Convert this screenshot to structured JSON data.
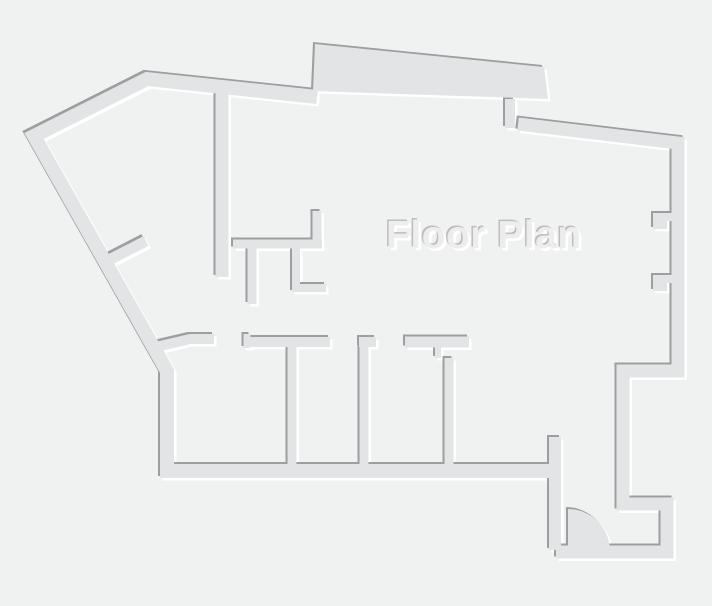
{
  "title": "Floor Plan",
  "canvas": {
    "width": 712,
    "height": 606
  },
  "colors": {
    "background": "#f0f1f1",
    "wall_fill": "#e3e4e5",
    "wall_shadow": "#9e9ea0",
    "wall_highlight": "#ffffff",
    "text_fill": "#ededee",
    "text_shadow": "#bdbdbe"
  },
  "emboss_layers": [
    {
      "id": "highlight",
      "dx": 2.5,
      "dy": 2.5,
      "colorKey": "wall_highlight"
    },
    {
      "id": "shadow",
      "dx": -2,
      "dy": -2,
      "colorKey": "wall_shadow"
    },
    {
      "id": "fill",
      "dx": 0,
      "dy": 0,
      "colorKey": "wall_fill"
    }
  ],
  "walls": [
    {
      "name": "outer-wall-left-and-bottom",
      "kind": "stroke",
      "w": 14,
      "d": "M 556 471 L 167 471 L 167 371 L 34 136 L 147 79 L 317 97"
    },
    {
      "name": "top-bump-slab",
      "kind": "fill",
      "w": 0,
      "d": "M 313 91 L 315 44 L 544 67 L 548 99 Z"
    },
    {
      "name": "outer-wall-right-and-vestibule",
      "kind": "stroke",
      "w": 13,
      "d": "M 518 124 L 678 143 L 678 371 L 623 371 L 623 504 L 667 504 L 667 552 L 556 552"
    },
    {
      "name": "entry-door-jamb",
      "kind": "stroke",
      "w": 12,
      "d": "M 555 437 L 555 550"
    },
    {
      "name": "right-wall-notch-upper",
      "kind": "stroke",
      "w": 8,
      "d": "M 677 217 L 657 217 L 657 225 L 667 225"
    },
    {
      "name": "right-wall-notch-lower",
      "kind": "stroke",
      "w": 8,
      "d": "M 677 279 L 657 279 L 657 287 L 667 287"
    },
    {
      "name": "interior-wall-vertical-left",
      "kind": "stroke",
      "w": 13,
      "d": "M 222 90 L 222 277"
    },
    {
      "name": "small-room-wall-horizontal",
      "kind": "stroke",
      "w": 9,
      "d": "M 233 244 L 322 244"
    },
    {
      "name": "small-room-stub-up",
      "kind": "stroke",
      "w": 9,
      "d": "M 317 248 L 317 211"
    },
    {
      "name": "small-room-partition",
      "kind": "stroke",
      "w": 9,
      "d": "M 252 247 L 252 304"
    },
    {
      "name": "small-room-l-wall",
      "kind": "stroke",
      "w": 8,
      "d": "M 296 248 L 296 288 L 326 288"
    },
    {
      "name": "diagonal-door-stub",
      "kind": "stroke",
      "w": 11,
      "d": "M 109 260 L 146 241"
    },
    {
      "name": "bump-under-stub",
      "kind": "stroke",
      "w": 10,
      "d": "M 510 99 L 510 128"
    },
    {
      "name": "room-header-slant-stub",
      "kind": "stroke",
      "w": 10,
      "d": "M 156 347 L 190 339 L 214 339"
    },
    {
      "name": "room-header-b-tab",
      "kind": "stroke",
      "w": 7,
      "d": "M 247 348 L 247 334"
    },
    {
      "name": "room-header-b",
      "kind": "stroke",
      "w": 10,
      "d": "M 244 342 L 330 342"
    },
    {
      "name": "room-header-c",
      "kind": "stroke",
      "w": 10,
      "d": "M 359 342 L 376 342"
    },
    {
      "name": "room-header-d",
      "kind": "stroke",
      "w": 11,
      "d": "M 405 342 L 469 342"
    },
    {
      "name": "room-header-d-tick",
      "kind": "stroke",
      "w": 6,
      "d": "M 438 344 L 438 358"
    },
    {
      "name": "room-partition-1",
      "kind": "stroke",
      "w": 9,
      "d": "M 292 341 L 292 466"
    },
    {
      "name": "room-partition-2",
      "kind": "stroke",
      "w": 9,
      "d": "M 364 341 L 364 466"
    },
    {
      "name": "room-partition-3",
      "kind": "stroke",
      "w": 9,
      "d": "M 449 358 L 449 467"
    },
    {
      "name": "entry-door-swing",
      "kind": "fill",
      "w": 0,
      "d": "M 568 551 L 568 509 A 42 42 0 0 1 610 551 Z"
    }
  ]
}
